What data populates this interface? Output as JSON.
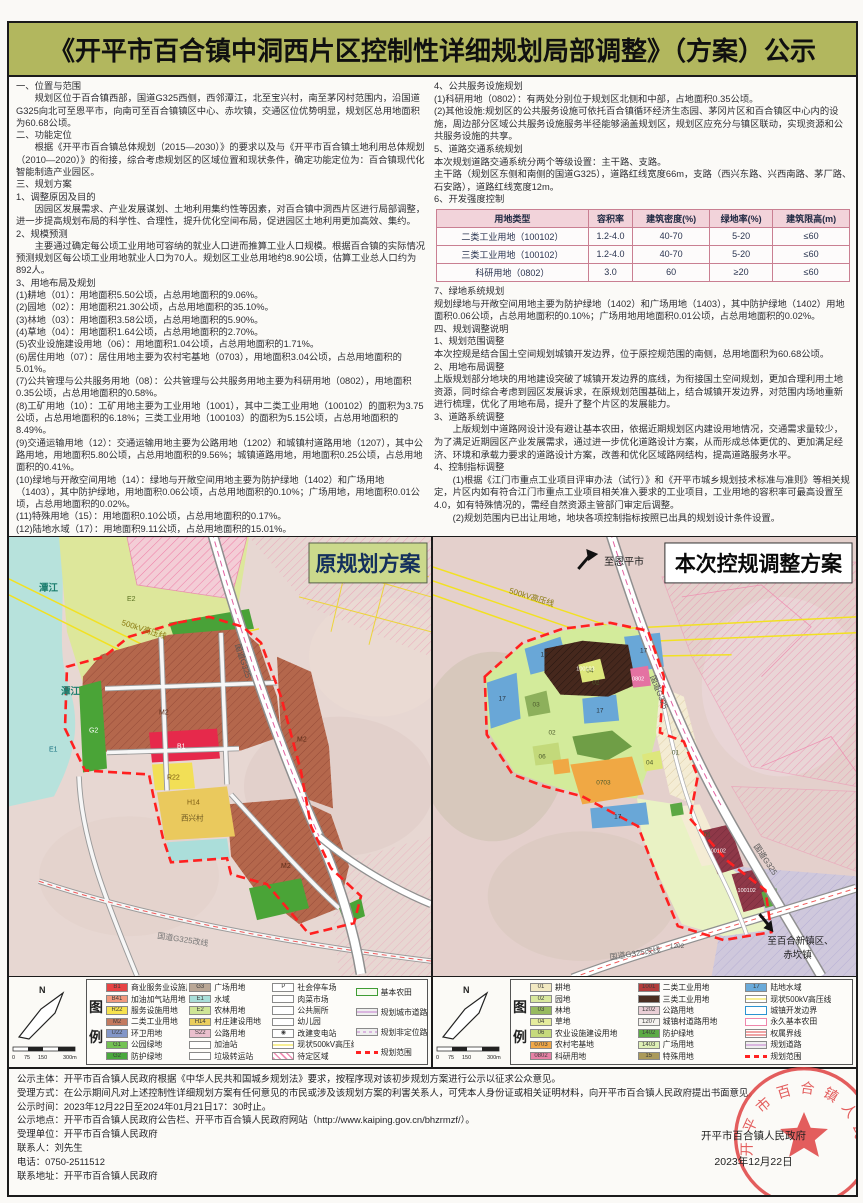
{
  "title": "《开平市百合镇中洞西片区控制性详细规划局部调整》（方案）公示",
  "left_column": {
    "paragraphs": [
      "一、位置与范围",
      "　　规划区位于百合镇西部，国道G325西侧，西邻潭江，北至宝兴村，南至茅冈村范围内，沿国道G325向北可至恩平市，向南可至百合镇镇区中心、赤坎镇，交通区位优势明显，规划区总用地面积为60.68公顷。",
      "二、功能定位",
      "　　根据《开平市百合镇总体规划（2015—2030）》的要求以及与《开平市百合镇土地利用总体规划（2010—2020）》的衔接，综合考虑规划区的区域位置和现状条件，确定功能定位为：百合镇现代化智能制造产业园区。",
      "三、规划方案",
      "1、调整原因及目的",
      "　　因园区发展需求、产业发展谋划、土地利用集约性等因素，对百合镇中洞西片区进行局部调整，进一步提高规划布局的科学性、合理性，提升优化空间布局，促进园区土地利用更加高效、集约。",
      "2、规模预测",
      "　　主要通过确定每公顷工业用地可容纳的就业人口进而推算工业人口规模。根据百合镇的实际情况预测规划区每公顷工业用地就业人口为70人。规划区工业总用地约8.90公顷，估算工业总人口约为892人。",
      "3、用地布局及规划",
      "(1)耕地（01）：用地面积5.50公顷，占总用地面积的9.06%。",
      "(2)园地（02）：用地面积21.30公顷，占总用地面积的35.10%。",
      "(3)林地（03）：用地面积3.58公顷，占总用地面积的5.90%。",
      "(4)草地（04）：用地面积1.64公顷，占总用地面积的2.70%。",
      "(5)农业设施建设用地（06）：用地面积1.04公顷，占总用地面积的1.71%。",
      "(6)居住用地（07）：居住用地主要为农村宅基地（0703），用地面积3.04公顷，占总用地面积的5.01%。",
      "(7)公共管理与公共服务用地（08）：公共管理与公共服务用地主要为科研用地（0802），用地面积0.35公顷，占总用地面积的0.58%。",
      "(8)工矿用地（10）：工矿用地主要为工业用地（1001），其中二类工业用地（100102）的面积为3.75公顷，占总用地面积的6.18%；三类工业用地（100103）的面积为5.15公顷，占总用地面积的8.49%。",
      "(9)交通运输用地（12）：交通运输用地主要为公路用地（1202）和城镇村道路用地（1207），其中公路用地，用地面积5.80公顷，占总用地面积的9.56%；城镇道路用地，用地面积0.25公顷，占总用地面积的0.41%。",
      "(10)绿地与开敞空间用地（14）：绿地与开敞空间用地主要为防护绿地（1402）和广场用地（1403），其中防护绿地，用地面积0.06公顷，占总用地面积的0.10%；广场用地，用地面积0.01公顷，占总用地面积的0.02%。",
      "(11)特殊用地（15）：用地面积0.10公顷，占总用地面积的0.17%。",
      "(12)陆地水域（17）：用地面积9.11公顷，占总用地面积的15.01%。"
    ]
  },
  "right_column": {
    "paragraphs_before_table": [
      "4、公共服务设施规划",
      "(1)科研用地（0802）：有两处分别位于规划区北侧和中部，占地面积0.35公顷。",
      "(2)其他设施:规划区的公共服务设施可依托百合镇循环经济生态园、茅冈片区和百合镇区中心内的设施，周边部分区域公共服务设施服务半径能够涵盖规划区，规划区应充分与镇区联动，实现资源和公共服务设施的共享。",
      "5、道路交通系统规划",
      "本次规划道路交通系统分两个等级设置：主干路、支路。",
      "主干路（规划区东侧和南侧的国道G325），道路红线宽度66m，支路（西兴东路、兴西南路、茅厂路、石安路），道路红线宽度12m。",
      "6、开发强度控制"
    ],
    "table": {
      "headers": [
        "用地类型",
        "容积率",
        "建筑密度(%)",
        "绿地率(%)",
        "建筑限高(m)"
      ],
      "rows": [
        {
          "c0": "二类工业用地（100102）",
          "c1": "1.2-4.0",
          "c2": "40-70",
          "c3": "5-20",
          "c4": "≤60"
        },
        {
          "c0": "三类工业用地（100102）",
          "c1": "1.2-4.0",
          "c2": "40-70",
          "c3": "5-20",
          "c4": "≤60"
        },
        {
          "c0": "科研用地（0802）",
          "c1": "3.0",
          "c2": "60",
          "c3": "≥20",
          "c4": "≤60"
        }
      ]
    },
    "paragraphs_after_table": [
      "7、绿地系统规划",
      "规划绿地与开敞空间用地主要为防护绿地（1402）和广场用地（1403），其中防护绿地（1402）用地面积0.06公顷，占总用地面积的0.10%；广场用地用地面积0.01公顷，占总用地面积的0.02%。",
      "四、规划调整说明",
      "1、规划范围调整",
      "本次控规是结合国土空间规划城镇开发边界，位于原控规范围的南侧，总用地面积为60.68公顷。",
      "2、用地布局调整",
      "上版规划部分地块的用地建设突破了城镇开发边界的底线，为衔接国土空间规划，更加合理利用土地资源，同时综合考虑到园区发展诉求，在原规划范围基础上，结合城镇开发边界，对范围内场地重新进行梳理，优化了用地布局，提升了整个片区的发展能力。",
      "3、道路系统调整",
      "　　上版规划中道路网设计没有避让基本农田，依据近期规划区内建设用地情况，交通需求量较少，为了满足近期园区产业发展需求，通过进一步优化道路设计方案，从而形成总体更优的、更加满足经济、环境和承载力要求的道路设计方案，改善和优化区域路网结构，提高道路服务水平。",
      "4、控制指标调整",
      "　　(1)根据《江门市重点工业项目评审办法（试行）》和《开平市城乡规划技术标准与准则》等相关规定，片区内如有符合江门市重点工业项目相关准入要求的工业项目，工业用地的容积率可最高设置至4.0，如有特殊情况的，需经自然资源主管部门审定后调整。",
      "　　(2)规划范围内已出让用地，地块各项控制指标按照已出具的规划设计条件设置。"
    ]
  },
  "maps": {
    "left": {
      "title": "原规划方案",
      "labels": {
        "tanjiang": "潭江",
        "hv": "500kV高压线",
        "g325": "国道G325",
        "g325gx": "国道G325改线",
        "village": "西兴村"
      },
      "codes": {
        "m2": "M2",
        "b1": "B1",
        "r22": "R22",
        "e1": "E1",
        "e2": "E2",
        "g2": "G2",
        "h14": "H14"
      },
      "legend": {
        "north": "N",
        "cap_chars": [
          "图",
          "例"
        ],
        "scale": [
          "0",
          "75",
          "150",
          "300m"
        ],
        "columns": [
          [
            {
              "code": "B1",
              "color": "#e84444",
              "label": "商业服务业设施用地"
            },
            {
              "code": "B41",
              "color": "#f2997d",
              "label": "加油加气站用地"
            },
            {
              "code": "R22",
              "color": "#f6e24e",
              "label": "服务设施用地"
            },
            {
              "code": "M2",
              "color": "#c37a5f",
              "label": "二类工业用地"
            },
            {
              "code": "U22",
              "color": "#8296c8",
              "label": "环卫用地"
            },
            {
              "code": "G1",
              "color": "#74c254",
              "label": "公园绿地"
            },
            {
              "code": "G2",
              "color": "#4aa83e",
              "label": "防护绿地"
            }
          ],
          [
            {
              "code": "G3",
              "color": "#baa795",
              "label": "广场用地"
            },
            {
              "code": "E1",
              "color": "#a9dfd9",
              "label": "水域"
            },
            {
              "code": "E2",
              "color": "#cfe596",
              "label": "农林用地"
            },
            {
              "code": "H14",
              "color": "#eace5e",
              "label": "村庄建设用地"
            },
            {
              "code": "S22",
              "color": "#eabfcd",
              "label": "公路用地"
            },
            {
              "code": "",
              "kind": "white",
              "label": "加油站"
            },
            {
              "code": "",
              "kind": "white",
              "label": "垃圾转运站"
            }
          ],
          [
            {
              "code": "P",
              "kind": "white",
              "label": "社会停车场"
            },
            {
              "code": "",
              "kind": "white",
              "label": "肉菜市场"
            },
            {
              "code": "",
              "kind": "white",
              "label": "公共厕所"
            },
            {
              "code": "",
              "kind": "white",
              "label": "幼儿园"
            },
            {
              "code": "◉",
              "kind": "white",
              "label": "改建变电站"
            },
            {
              "kind": "line-yellow",
              "label": "现状500kV高压线"
            },
            {
              "kind": "hatch-pink",
              "label": "待定区域"
            }
          ],
          [
            {
              "kind": "outline-green",
              "label": "基本农田"
            },
            {
              "kind": "road",
              "label": "规划城市道路"
            },
            {
              "kind": "road2",
              "label": "规划非定位路"
            },
            {
              "kind": "dash-red",
              "label": "规划范围"
            }
          ]
        ]
      }
    },
    "right": {
      "title": "本次控规调整方案",
      "labels": {
        "to_enping": "至恩平市",
        "hv": "500kV高压线",
        "g325": "国道G325",
        "g325gx": "国道G325改线",
        "to_baihe": "至百合新镇区、",
        "chikan": "赤坎镇"
      },
      "codes": {
        "c17": "17",
        "c02": "02",
        "c03": "03",
        "c04": "04",
        "c06": "06",
        "c01": "01",
        "c0703": "0703",
        "c0802": "0802",
        "c100102": "100102",
        "c100103": "100103",
        "c1202": "1202"
      },
      "legend": {
        "north": "N",
        "cap_chars": [
          "图",
          "例"
        ],
        "scale": [
          "0",
          "75",
          "150",
          "300m"
        ],
        "columns": [
          [
            {
              "code": "01",
              "color": "#f2e9c2",
              "label": "耕地"
            },
            {
              "code": "02",
              "color": "#d9e89e",
              "label": "园地"
            },
            {
              "code": "03",
              "color": "#97ba5e",
              "label": "林地"
            },
            {
              "code": "04",
              "color": "#e5ec9c",
              "label": "草地"
            },
            {
              "code": "06",
              "color": "#c6da7c",
              "label": "农业设施建设用地"
            },
            {
              "code": "0703",
              "color": "#f0a848",
              "label": "农村宅基地"
            },
            {
              "code": "0802",
              "color": "#e782a6",
              "label": "科研用地"
            }
          ],
          [
            {
              "code": "1001",
              "color": "#b23c3c",
              "label": "二类工业用地"
            },
            {
              "code": "",
              "color": "#4a2e22",
              "label": "三类工业用地"
            },
            {
              "code": "1202",
              "color": "#eacfd6",
              "label": "公路用地"
            },
            {
              "code": "1207",
              "color": "#f4f1ee",
              "label": "城镇村道路用地"
            },
            {
              "code": "1402",
              "color": "#5cab45",
              "label": "防护绿地"
            },
            {
              "code": "1403",
              "color": "#dff0b6",
              "label": "广场用地"
            },
            {
              "code": "15",
              "color": "#ab9a5a",
              "label": "特殊用地"
            }
          ],
          [
            {
              "code": "17",
              "color": "#6aaad9",
              "label": "陆地水域"
            },
            {
              "kind": "line-yellow",
              "label": "现状500kV高压线"
            },
            {
              "kind": "outline-blue",
              "label": "城镇开发边界"
            },
            {
              "kind": "outline-pink",
              "label": "永久基本农田"
            },
            {
              "kind": "line-red2",
              "label": "权属界线"
            },
            {
              "kind": "road",
              "label": "规划道路"
            },
            {
              "kind": "dash-red",
              "label": "规划范围"
            }
          ]
        ]
      }
    }
  },
  "notice": {
    "lines": [
      "公示主体：开平市百合镇人民政府根据《中华人民共和国城乡规划法》要求，按程序现对该初步规划方案进行公示以征求公众意见。",
      "受理方式：在公示期间凡对上述控制性详细规划方案有任何意见的市民或涉及该规划方案的利害关系人，可凭本人身份证或相关证明材料，向开平市百合镇人民政府提出书面意见。",
      "公示时间：2023年12月22日至2024年01月21日17：30时止。",
      "公示地点：开平市百合镇人民政府公告栏、开平市百合镇人民政府网站（http://www.kaiping.gov.cn/bhzrmzf/）。",
      "受理单位：开平市百合镇人民政府",
      "联系人：刘先生",
      "电话：0750-2511512",
      "联系地址：开平市百合镇人民政府"
    ]
  },
  "signature": {
    "org": "开平市百合镇人民政府",
    "date": "2023年12月22日",
    "seal_text": "开平市百合镇人民政府"
  },
  "colors": {
    "title_bg": "#b2b75e",
    "boundary_red": "#ff2020",
    "table_header_bg": "#f2d3da",
    "left_banner_bg": "#cbd98c"
  }
}
